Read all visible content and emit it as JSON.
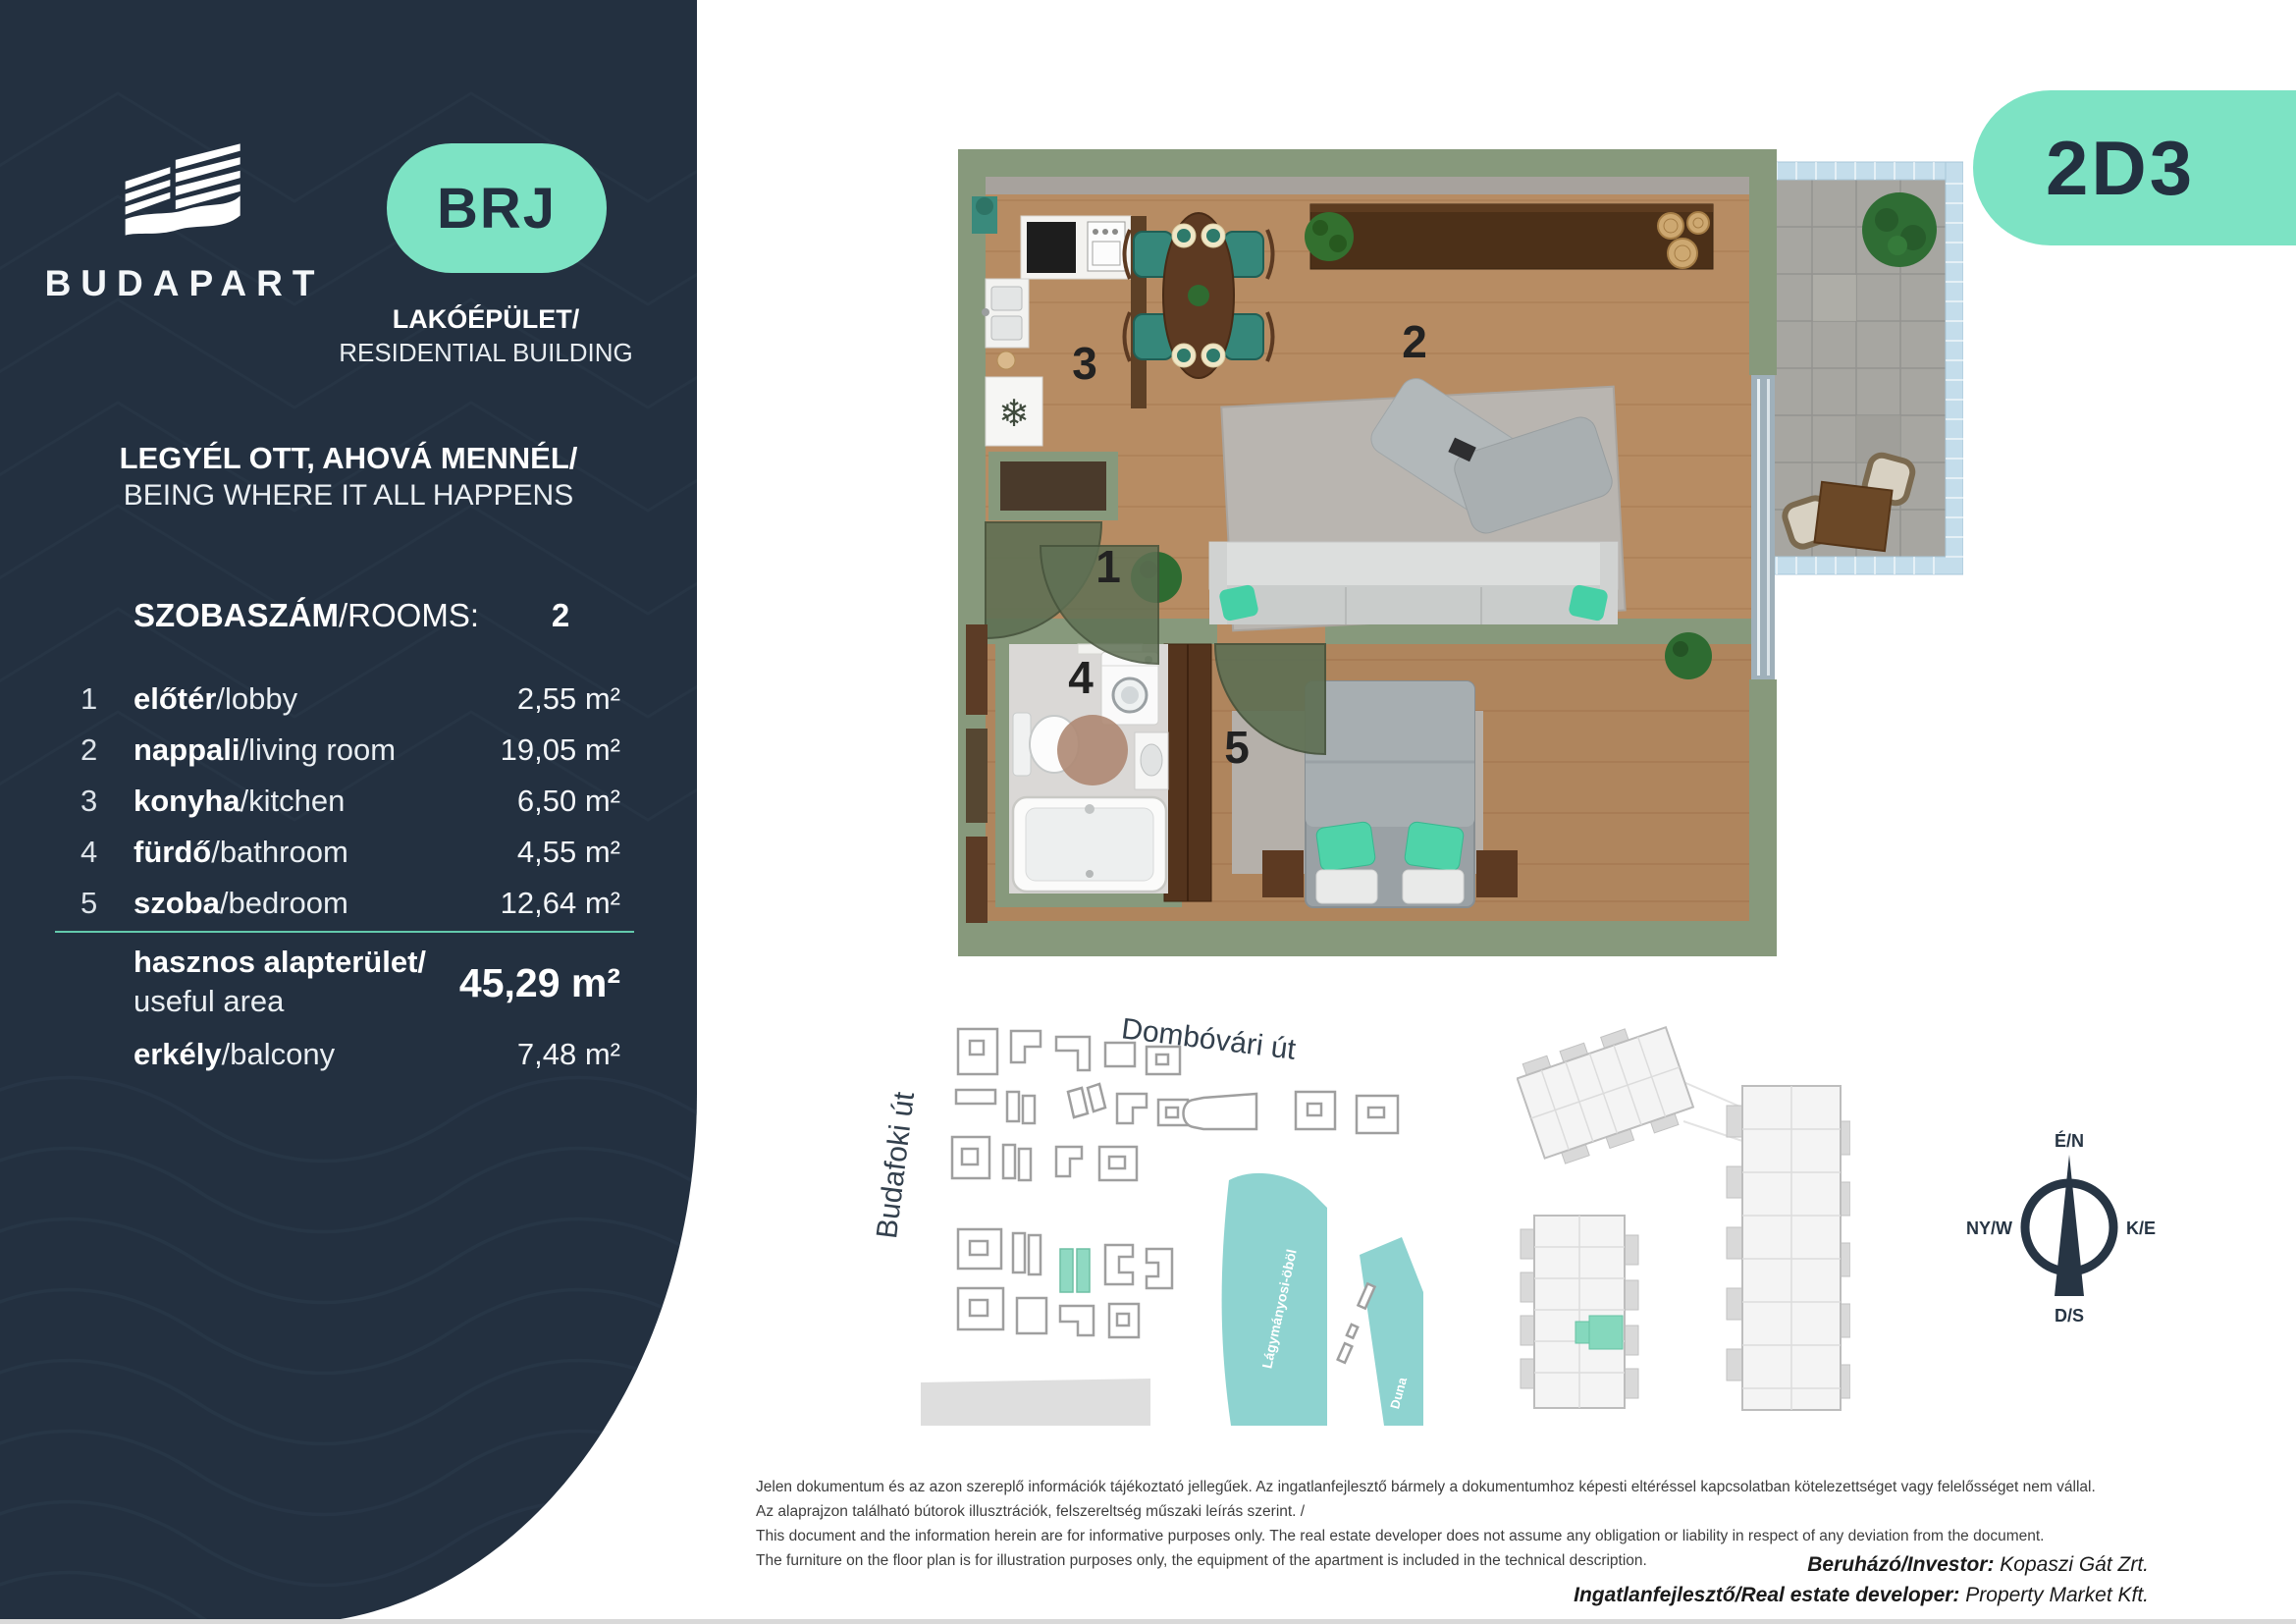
{
  "sidebar": {
    "logo_text": "BUDAPART",
    "badge": "BRJ",
    "building_type_hu": "LAKÓÉPÜLET/",
    "building_type_en": "RESIDENTIAL BUILDING",
    "tagline_hu": "LEGYÉL OTT, AHOVÁ MENNÉL/",
    "tagline_en": "BEING WHERE IT ALL HAPPENS",
    "rooms_header": {
      "label_hu": "SZOBASZÁM",
      "label_sep": "/ROOMS:",
      "value": "2"
    },
    "rooms": [
      {
        "num": "1",
        "name_hu": "előtér",
        "name_en": "/lobby",
        "area": "2,55 m²"
      },
      {
        "num": "2",
        "name_hu": "nappali",
        "name_en": "/living room",
        "area": "19,05 m²"
      },
      {
        "num": "3",
        "name_hu": "konyha",
        "name_en": "/kitchen",
        "area": "6,50 m²"
      },
      {
        "num": "4",
        "name_hu": "fürdő",
        "name_en": "/bathroom",
        "area": "4,55 m²"
      },
      {
        "num": "5",
        "name_hu": "szoba",
        "name_en": "/bedroom",
        "area": "12,64 m²"
      }
    ],
    "total": {
      "label_hu": "hasznos alapterület/",
      "label_en": "useful area",
      "value": "45,29 m²"
    },
    "balcony": {
      "label_hu": "erkély",
      "label_en": "/balcony",
      "value": "7,48 m²"
    }
  },
  "unit_badge": "2D3",
  "floor_plan": {
    "labels": {
      "lobby": "1",
      "living": "2",
      "kitchen": "3",
      "bath": "4",
      "bedroom": "5"
    }
  },
  "site_map": {
    "street_top": "Dombóvári út",
    "street_left": "Budafoki út",
    "bay": "Lágymányosi-öböl",
    "river": "Duna"
  },
  "compass": {
    "north": "É/N",
    "west": "NY/W",
    "east": "K/E",
    "south": "D/S"
  },
  "disclaimer": [
    "Jelen dokumentum és az azon szereplő információk tájékoztató jellegűek. Az ingatlanfejlesztő bármely a dokumentumhoz képesti eltéréssel kapcsolatban kötelezettséget vagy felelősséget nem vállal.",
    "Az alaprajzon található bútorok illusztrációk, felszereltség műszaki leírás szerint. /",
    "This document and the information herein are for informative purposes only. The real estate developer does not assume any obligation or liability in respect of any deviation from the document.",
    "The furniture on the floor plan is for illustration purposes only, the equipment of the apartment is included in the technical description."
  ],
  "footer": {
    "investor_label": "Beruházó/Investor:",
    "investor_value": " Kopaszi Gát Zrt.",
    "developer_label": "Ingatlanfejlesztő/Real estate developer:",
    "developer_value": " Property Market Kft."
  },
  "colors": {
    "navy": "#233040",
    "mint": "#7de3c4",
    "sage": "#87997c",
    "wood": "#b78c63",
    "water": "#8ed3d0"
  }
}
